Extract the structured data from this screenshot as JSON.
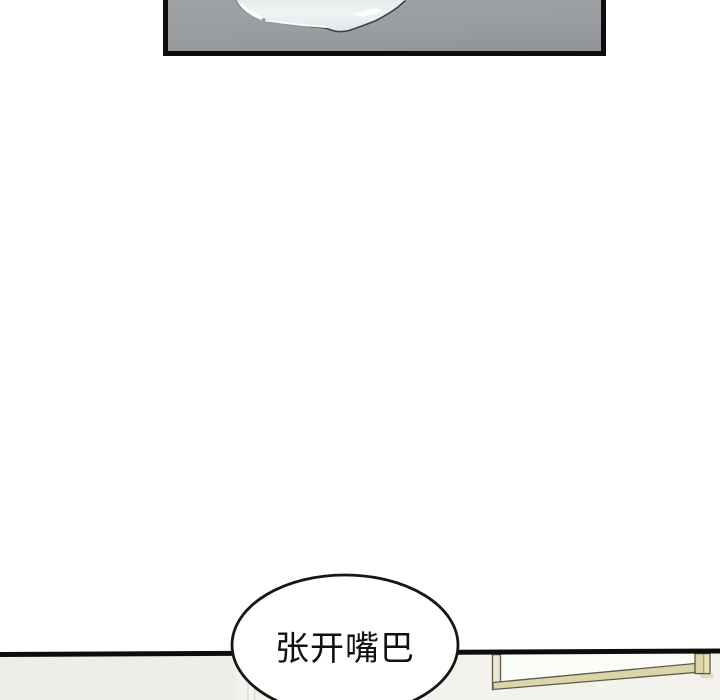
{
  "bubble": {
    "text": "张开嘴巴"
  },
  "drawings": {
    "top_panel": "gray-floor-with-spilled-liquid",
    "puddle": "spilled-white-liquid",
    "bottom_right": "bed-frame-edge"
  },
  "colors": {
    "page_bg": "#ffffff",
    "ink": "#0d0d0d",
    "floor_gray": "#999da0",
    "puddle_fill": "#eef0f1",
    "puddle_outline": "#3a4045",
    "bubble_fill": "#ffffff",
    "bubble_stroke": "#161616",
    "text_color": "#111111",
    "lower_bg_left": "#efedea",
    "lower_bg_right": "#f4f2ec",
    "lower_line": "#dcd9d2",
    "lower_strip": "#f7f5f1",
    "frame_beige": "#dcd5a8",
    "frame_beige_light": "#e7e1bb",
    "frame_outline": "#5c5a4c",
    "frame_inner_white": "#fbfbf7",
    "frame_post": "#ebe7d4",
    "frame_shadow": "#dedaca"
  }
}
